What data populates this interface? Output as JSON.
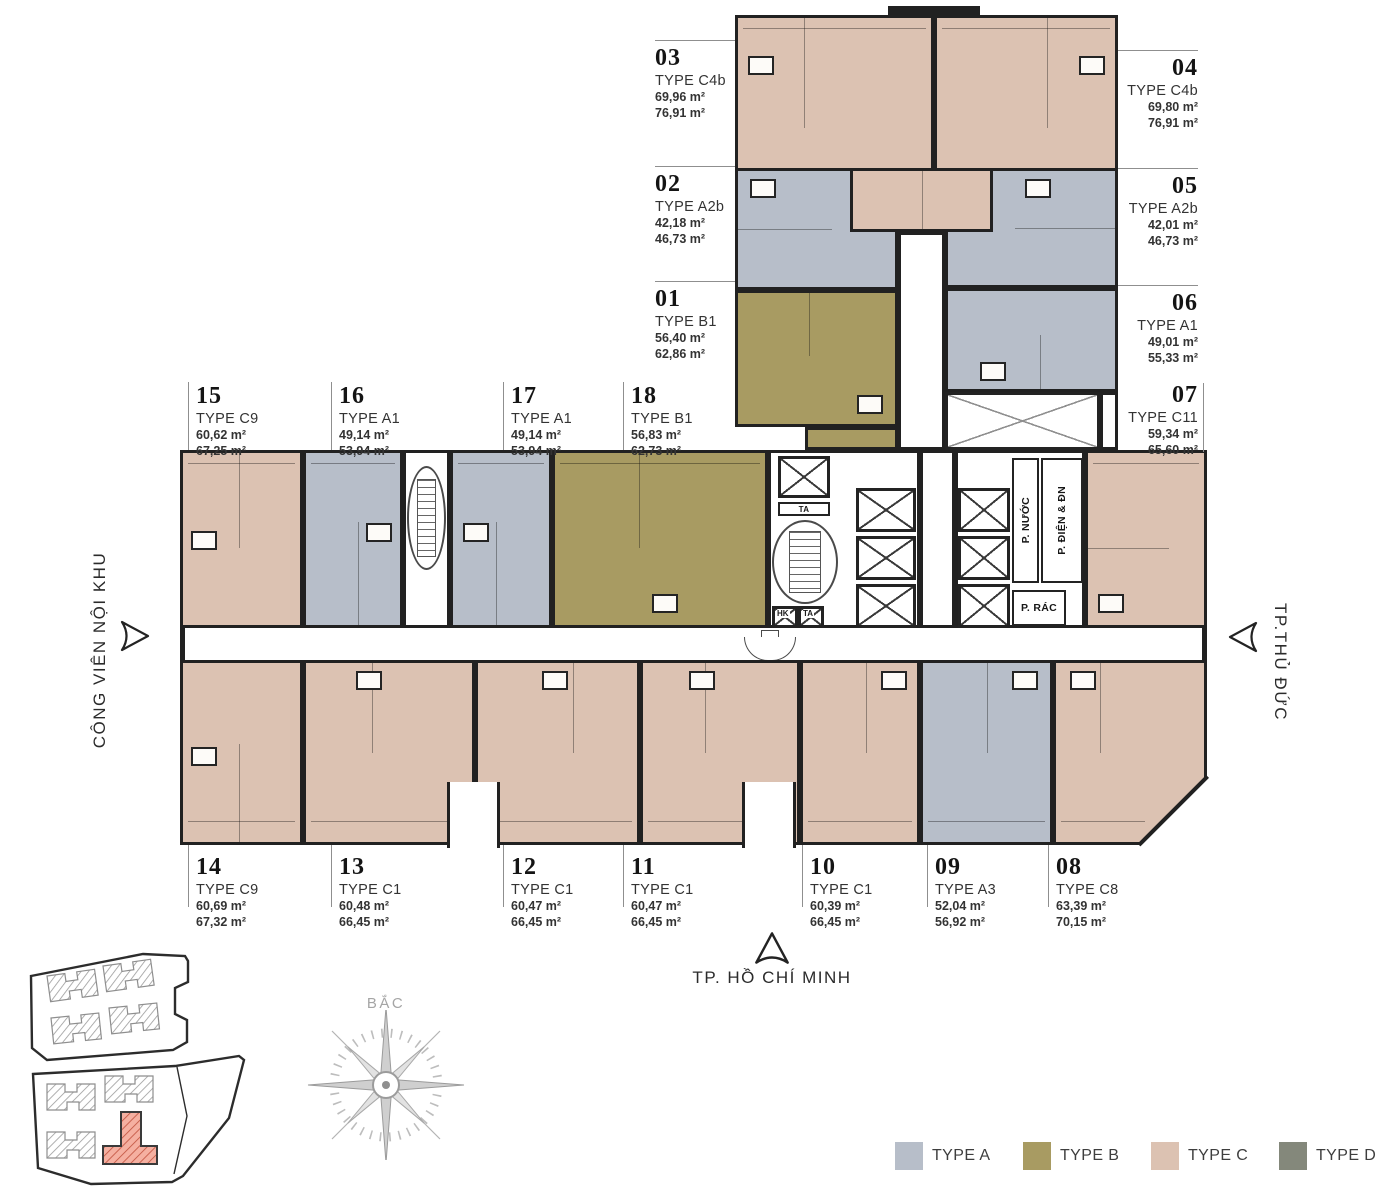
{
  "units": {
    "u01": {
      "num": "01",
      "type": "TYPE B1",
      "area_net": "56,40 m²",
      "area_gross": "62,86 m²"
    },
    "u02": {
      "num": "02",
      "type": "TYPE A2b",
      "area_net": "42,18 m²",
      "area_gross": "46,73 m²"
    },
    "u03": {
      "num": "03",
      "type": "TYPE C4b",
      "area_net": "69,96 m²",
      "area_gross": "76,91 m²"
    },
    "u04": {
      "num": "04",
      "type": "TYPE C4b",
      "area_net": "69,80 m²",
      "area_gross": "76,91 m²"
    },
    "u05": {
      "num": "05",
      "type": "TYPE A2b",
      "area_net": "42,01 m²",
      "area_gross": "46,73 m²"
    },
    "u06": {
      "num": "06",
      "type": "TYPE A1",
      "area_net": "49,01 m²",
      "area_gross": "55,33 m²"
    },
    "u07": {
      "num": "07",
      "type": "TYPE C11",
      "area_net": "59,34 m²",
      "area_gross": "65,60 m²"
    },
    "u08": {
      "num": "08",
      "type": "TYPE C8",
      "area_net": "63,39 m²",
      "area_gross": "70,15 m²"
    },
    "u09": {
      "num": "09",
      "type": "TYPE A3",
      "area_net": "52,04 m²",
      "area_gross": "56,92 m²"
    },
    "u10": {
      "num": "10",
      "type": "TYPE C1",
      "area_net": "60,39 m²",
      "area_gross": "66,45 m²"
    },
    "u11": {
      "num": "11",
      "type": "TYPE C1",
      "area_net": "60,47 m²",
      "area_gross": "66,45 m²"
    },
    "u12": {
      "num": "12",
      "type": "TYPE C1",
      "area_net": "60,47 m²",
      "area_gross": "66,45 m²"
    },
    "u13": {
      "num": "13",
      "type": "TYPE C1",
      "area_net": "60,48 m²",
      "area_gross": "66,45 m²"
    },
    "u14": {
      "num": "14",
      "type": "TYPE C9",
      "area_net": "60,69 m²",
      "area_gross": "67,32 m²"
    },
    "u15": {
      "num": "15",
      "type": "TYPE C9",
      "area_net": "60,62 m²",
      "area_gross": "67,25 m²"
    },
    "u16": {
      "num": "16",
      "type": "TYPE A1",
      "area_net": "49,14 m²",
      "area_gross": "53,94 m²"
    },
    "u17": {
      "num": "17",
      "type": "TYPE A1",
      "area_net": "49,14 m²",
      "area_gross": "53,94 m²"
    },
    "u18": {
      "num": "18",
      "type": "TYPE B1",
      "area_net": "56,83 m²",
      "area_gross": "62,73 m²"
    }
  },
  "core": {
    "water_room": "P. NƯỚC",
    "electrical_room": "P. ĐIỆN & ĐN",
    "trash_room": "P. RÁC",
    "elevator_ta": "TA",
    "elevator_hk": "HK"
  },
  "directions": {
    "north": "BẮC",
    "west": "CÔNG VIÊN NỘI KHU",
    "east": "TP.THỦ ĐỨC",
    "south": "TP. HỒ CHÍ MINH"
  },
  "legend": {
    "items": [
      {
        "label": "TYPE A",
        "color": "#b7bec9"
      },
      {
        "label": "TYPE B",
        "color": "#a89b62"
      },
      {
        "label": "TYPE C",
        "color": "#dcc2b2"
      },
      {
        "label": "TYPE D",
        "color": "#84887b"
      }
    ]
  }
}
